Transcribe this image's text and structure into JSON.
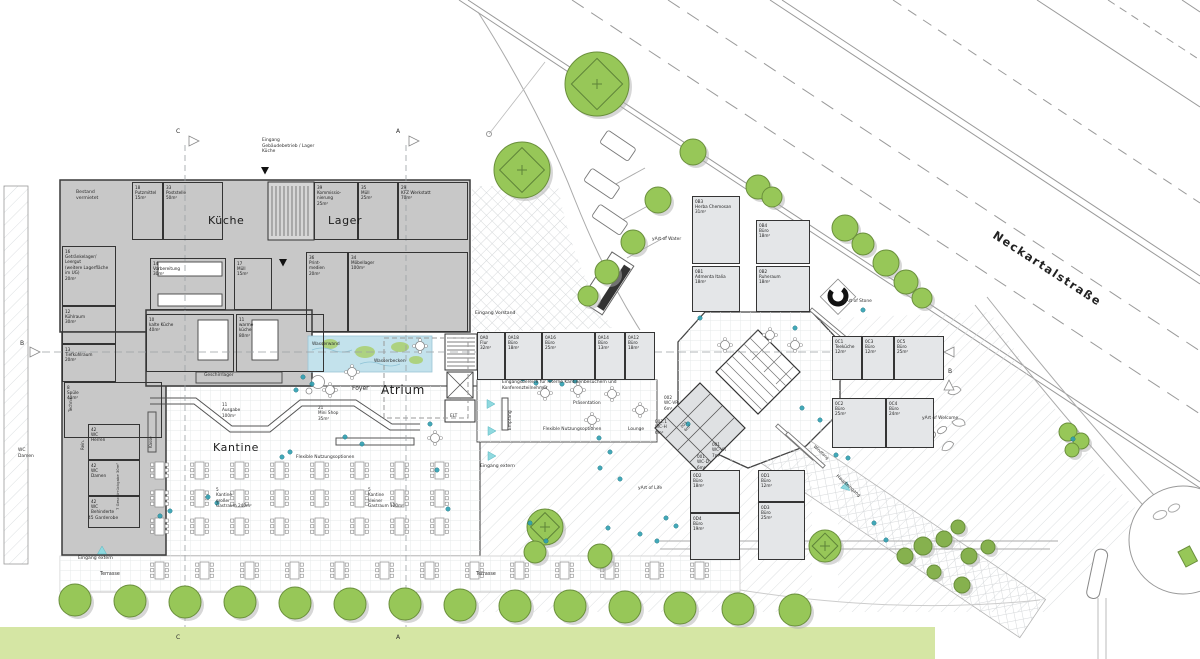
{
  "areas": {
    "kueche": "Küche",
    "lager": "Lager",
    "kantine": "Kantine",
    "atrium": "Atrium",
    "street_name": "Neckartalstraße"
  },
  "colors": {
    "accent_teal": "#2fa0b2",
    "entry_cyan": "#8fd9df",
    "tree_green": "#97c758",
    "tree_stroke": "#6a8f3c",
    "bush_green": "#86b14e",
    "green_band": "#d5e6a4",
    "building_gray": "#c8c8c8",
    "office_fill": "#e4e6e8",
    "wall": "#3a3a3a",
    "water": "#c3e2ec"
  },
  "rooms": [
    {
      "id": "18",
      "name": "Putzmittel",
      "area": "15m²",
      "x": 132,
      "y": 182,
      "w": 31,
      "h": 58,
      "cls": "g"
    },
    {
      "id": "33",
      "name": "Poststelle",
      "area": "50m²",
      "x": 163,
      "y": 182,
      "w": 60,
      "h": 58,
      "cls": "g"
    },
    {
      "id": "39",
      "name": "Kommissio-\nnierung",
      "area": "25m²",
      "x": 314,
      "y": 182,
      "w": 44,
      "h": 58,
      "cls": "g"
    },
    {
      "id": "35",
      "name": "Müll",
      "area": "25m²",
      "x": 358,
      "y": 182,
      "w": 40,
      "h": 58,
      "cls": "g"
    },
    {
      "id": "29",
      "name": "KFZ Werkstatt",
      "area": "70m²",
      "x": 398,
      "y": 182,
      "w": 70,
      "h": 58,
      "cls": "g"
    },
    {
      "id": "16",
      "name": "Getränkelager/\nLeergut\n(weitere Lagerfläche\nim UG)",
      "area": "20m²",
      "x": 62,
      "y": 246,
      "w": 54,
      "h": 60,
      "cls": "g"
    },
    {
      "id": "12",
      "name": "Kühlraum",
      "area": "30m²",
      "x": 62,
      "y": 306,
      "w": 54,
      "h": 38,
      "cls": "g"
    },
    {
      "id": "13",
      "name": "Tiefkühlraum",
      "area": "20m²",
      "x": 62,
      "y": 344,
      "w": 54,
      "h": 38,
      "cls": "g"
    },
    {
      "id": "8",
      "name": "Spüle",
      "area": "40m²",
      "x": 64,
      "y": 382,
      "w": 98,
      "h": 56,
      "cls": "g"
    },
    {
      "id": "14",
      "name": "Vorbereitung",
      "area": "30m²",
      "x": 150,
      "y": 258,
      "w": 76,
      "h": 52,
      "cls": "g"
    },
    {
      "id": "17",
      "name": "Müll",
      "area": "15m²",
      "x": 234,
      "y": 258,
      "w": 38,
      "h": 52,
      "cls": "g"
    },
    {
      "id": "36",
      "name": "Print-\nmedien",
      "area": "20m²",
      "x": 306,
      "y": 252,
      "w": 42,
      "h": 80,
      "cls": "g"
    },
    {
      "id": "34",
      "name": "Möbellager",
      "area": "100m²",
      "x": 348,
      "y": 252,
      "w": 120,
      "h": 80,
      "cls": "g"
    },
    {
      "id": "10",
      "name": "kalte Küche",
      "area": "40m²",
      "x": 146,
      "y": 314,
      "w": 88,
      "h": 58,
      "cls": "g"
    },
    {
      "id": "11",
      "name": "warme\nküche",
      "area": "80m²",
      "x": 236,
      "y": 314,
      "w": 88,
      "h": 58,
      "cls": "g"
    },
    {
      "id": "42",
      "name": "WC\nHerren",
      "area": "",
      "x": 88,
      "y": 424,
      "w": 52,
      "h": 36,
      "cls": "g"
    },
    {
      "id": "42",
      "name": "WC\nDamen",
      "area": "",
      "x": 88,
      "y": 460,
      "w": 52,
      "h": 36,
      "cls": "g"
    },
    {
      "id": "42",
      "name": "WC\nBehinderte",
      "area": "",
      "x": 88,
      "y": 496,
      "w": 52,
      "h": 32,
      "cls": "g"
    },
    {
      "id": "0A0",
      "name": "Flur",
      "area": "32m²",
      "x": 477,
      "y": 332,
      "w": 28,
      "h": 48,
      "cls": "o"
    },
    {
      "id": "0A18",
      "name": "Büro",
      "area": "18m²",
      "x": 505,
      "y": 332,
      "w": 37,
      "h": 48,
      "cls": "o"
    },
    {
      "id": "0A16",
      "name": "Büro",
      "area": "25m²",
      "x": 542,
      "y": 332,
      "w": 53,
      "h": 48,
      "cls": "o"
    },
    {
      "id": "0A14",
      "name": "Büro",
      "area": "13m²",
      "x": 595,
      "y": 332,
      "w": 30,
      "h": 48,
      "cls": "o"
    },
    {
      "id": "0A12",
      "name": "Büro",
      "area": "18m²",
      "x": 625,
      "y": 332,
      "w": 30,
      "h": 48,
      "cls": "o"
    },
    {
      "id": "0B3",
      "name": "Herba Chemosan",
      "area": "31m²",
      "x": 692,
      "y": 196,
      "w": 48,
      "h": 68,
      "cls": "o"
    },
    {
      "id": "0B4",
      "name": "Büro",
      "area": "18m²",
      "x": 756,
      "y": 220,
      "w": 54,
      "h": 44,
      "cls": "o"
    },
    {
      "id": "0B1",
      "name": "Admenta Italia",
      "area": "18m²",
      "x": 692,
      "y": 266,
      "w": 48,
      "h": 46,
      "cls": "o"
    },
    {
      "id": "0B2",
      "name": "Ruheraum",
      "area": "18m²",
      "x": 756,
      "y": 266,
      "w": 54,
      "h": 46,
      "cls": "o"
    },
    {
      "id": "0C1",
      "name": "Teeküche",
      "area": "12m²",
      "x": 832,
      "y": 336,
      "w": 30,
      "h": 44,
      "cls": "o"
    },
    {
      "id": "0C3",
      "name": "Büro",
      "area": "12m²",
      "x": 862,
      "y": 336,
      "w": 32,
      "h": 44,
      "cls": "o"
    },
    {
      "id": "0C5",
      "name": "Büro",
      "area": "25m²",
      "x": 894,
      "y": 336,
      "w": 50,
      "h": 44,
      "cls": "o"
    },
    {
      "id": "0C2",
      "name": "Büro",
      "area": "25m²",
      "x": 832,
      "y": 398,
      "w": 54,
      "h": 50,
      "cls": "o"
    },
    {
      "id": "0C4",
      "name": "Büro",
      "area": "24m²",
      "x": 886,
      "y": 398,
      "w": 48,
      "h": 50,
      "cls": "o"
    },
    {
      "id": "0D2",
      "name": "Büro",
      "area": "18m²",
      "x": 690,
      "y": 470,
      "w": 50,
      "h": 43,
      "cls": "o"
    },
    {
      "id": "0D1",
      "name": "Büro",
      "area": "12m²",
      "x": 758,
      "y": 470,
      "w": 47,
      "h": 32,
      "cls": "o"
    },
    {
      "id": "0D4",
      "name": "Büro",
      "area": "19m²",
      "x": 690,
      "y": 513,
      "w": 50,
      "h": 47,
      "cls": "o"
    },
    {
      "id": "0D3",
      "name": "Büro",
      "area": "25m²",
      "x": 758,
      "y": 502,
      "w": 47,
      "h": 58,
      "cls": "o"
    },
    {
      "id": "5",
      "name": "Kantine\ngroßer\nGastraum 240m²",
      "area": "",
      "x": 216,
      "y": 487,
      "w": 0,
      "h": 0
    },
    {
      "id": "5",
      "name": "Kantine\nkleiner\nGastraum 120m²",
      "area": "",
      "x": 368,
      "y": 487,
      "w": 0,
      "h": 0
    },
    {
      "id": "11",
      "name": "Ausgabe",
      "area": "100m²",
      "x": 222,
      "y": 402,
      "w": 0,
      "h": 0
    },
    {
      "id": "21",
      "name": "Mini Shop",
      "area": "35m²",
      "x": 318,
      "y": 405,
      "w": 0,
      "h": 0
    },
    {
      "id": "002",
      "name": "WC-VR",
      "area": "6m²",
      "x": 664,
      "y": 395,
      "w": 0,
      "h": 0
    },
    {
      "id": "002.1",
      "name": "WC-H",
      "area": "6m²",
      "x": 655,
      "y": 419,
      "w": 0,
      "h": 0
    },
    {
      "id": "001",
      "name": "WC-VR",
      "area": "7m²",
      "x": 712,
      "y": 442,
      "w": 0,
      "h": 0
    },
    {
      "id": "001",
      "name": "WC-D",
      "area": "6m²",
      "x": 697,
      "y": 454,
      "w": 0,
      "h": 0
    }
  ],
  "labels": [
    {
      "t": "Foyer",
      "x": 352,
      "y": 385,
      "s": 6,
      "n": "area-foyer"
    },
    {
      "t": "Bestand\nvermietet",
      "x": 76,
      "y": 190,
      "s": 4.6,
      "n": "bestand-label"
    },
    {
      "t": "Wasserwand",
      "x": 312,
      "y": 342,
      "s": 4.4,
      "n": "wasserwand-label"
    },
    {
      "t": "Wasserbecken",
      "x": 374,
      "y": 359,
      "s": 4.4,
      "n": "wasserbecken-label"
    },
    {
      "t": "Geschirrlager",
      "x": 204,
      "y": 373,
      "s": 4.4,
      "n": "geschirrlager-label"
    },
    {
      "t": "Terrasse",
      "x": 100,
      "y": 572,
      "s": 4.8,
      "n": "terrasse-label"
    },
    {
      "t": "Terrasse",
      "x": 476,
      "y": 572,
      "s": 4.8,
      "n": "terrasse-label"
    },
    {
      "t": "Eingang extern",
      "x": 78,
      "y": 556,
      "s": 4.6,
      "n": "entrance-label"
    },
    {
      "t": "Eingang extern",
      "x": 480,
      "y": 464,
      "s": 4.6,
      "n": "entrance-label"
    },
    {
      "t": "Eingang Vorstand",
      "x": 475,
      "y": 311,
      "s": 4.6,
      "n": "entrance-label"
    },
    {
      "t": "Eingang\nGebäudebetrieb / Lager\nKüche",
      "x": 262,
      "y": 138,
      "s": 4.4,
      "n": "entrance-label"
    },
    {
      "t": "Eingangsbereich für interne Kantinenbesuchern und\nKonferenzteilnehmer",
      "x": 502,
      "y": 380,
      "s": 4.4,
      "n": "annotation"
    },
    {
      "t": "Präsentation",
      "x": 573,
      "y": 401,
      "s": 4.4,
      "n": "area-praesentation"
    },
    {
      "t": "Flexible Nutzungsoptionen",
      "x": 543,
      "y": 427,
      "s": 4.4,
      "n": "area-flexible"
    },
    {
      "t": "Flexible Nutzungsoptionen",
      "x": 296,
      "y": 455,
      "s": 4.4,
      "n": "area-flexible"
    },
    {
      "t": "Lounge",
      "x": 628,
      "y": 427,
      "s": 4.4,
      "n": "area-lounge"
    },
    {
      "t": "Empfang",
      "x": 508,
      "y": 430,
      "s": 4.4,
      "rot": -90,
      "n": "area-empfang"
    },
    {
      "t": "Kasse",
      "x": 148,
      "y": 448,
      "s": 4,
      "rot": -90,
      "n": "area-kasse"
    },
    {
      "t": "Technik",
      "x": 68,
      "y": 412,
      "s": 4,
      "rot": -90,
      "n": "area-technik"
    },
    {
      "t": "Rein.",
      "x": 80,
      "y": 450,
      "s": 4,
      "rot": -90,
      "n": "area-rein"
    },
    {
      "t": "7 Geschirrückgabe 30m²",
      "x": 116,
      "y": 510,
      "s": 3.8,
      "rot": -90,
      "n": "area-geschirrrueckgabe"
    },
    {
      "t": "45 Garderobe",
      "x": 88,
      "y": 516,
      "s": 4.4,
      "n": "area-garderobe"
    },
    {
      "t": "WC\nDamen",
      "x": 18,
      "y": 448,
      "s": 4.4,
      "n": "wc-damen-sign"
    },
    {
      "t": "yArt of Water",
      "x": 652,
      "y": 237,
      "s": 4.4,
      "n": "art-label"
    },
    {
      "t": "yArt of Stone",
      "x": 843,
      "y": 299,
      "s": 4.4,
      "n": "art-label"
    },
    {
      "t": "yArt of Welcome",
      "x": 922,
      "y": 416,
      "s": 4.4,
      "n": "art-label"
    },
    {
      "t": "yArt of Life",
      "x": 638,
      "y": 486,
      "s": 4.4,
      "n": "art-label"
    },
    {
      "t": "Haupteingang",
      "x": 838,
      "y": 474,
      "s": 4.4,
      "rot": 42,
      "n": "entrance-label"
    },
    {
      "t": "Windfang",
      "x": 816,
      "y": 444,
      "s": 4,
      "rot": 42,
      "n": "area-windfang"
    },
    {
      "t": "ELT",
      "x": 450,
      "y": 414,
      "s": 4.4,
      "n": "area-elt"
    },
    {
      "t": "003\n6m²",
      "x": 680,
      "y": 426,
      "s": 3.8,
      "rot": -45,
      "n": "room-003-label"
    },
    {
      "t": "A",
      "x": 396,
      "y": 128,
      "s": 6,
      "n": "section-letter"
    },
    {
      "t": "C",
      "x": 176,
      "y": 128,
      "s": 6,
      "n": "section-letter"
    },
    {
      "t": "B",
      "x": 20,
      "y": 340,
      "s": 6,
      "n": "section-letter"
    },
    {
      "t": "B",
      "x": 948,
      "y": 368,
      "s": 6,
      "n": "section-letter"
    },
    {
      "t": "C",
      "x": 176,
      "y": 634,
      "s": 6,
      "n": "section-letter"
    },
    {
      "t": "A",
      "x": 396,
      "y": 634,
      "s": 6,
      "n": "section-letter"
    }
  ],
  "trees": [
    [
      75,
      600,
      16,
      0
    ],
    [
      130,
      601,
      16,
      0
    ],
    [
      185,
      602,
      16,
      0
    ],
    [
      240,
      602,
      16,
      0
    ],
    [
      295,
      603,
      16,
      0
    ],
    [
      350,
      604,
      16,
      0
    ],
    [
      405,
      604,
      16,
      0
    ],
    [
      460,
      605,
      16,
      0
    ],
    [
      515,
      606,
      16,
      0
    ],
    [
      570,
      606,
      16,
      0
    ],
    [
      625,
      607,
      16,
      0
    ],
    [
      680,
      608,
      16,
      0
    ],
    [
      738,
      609,
      16,
      0
    ],
    [
      795,
      610,
      16,
      0
    ],
    [
      693,
      152,
      13,
      0
    ],
    [
      758,
      187,
      12,
      0
    ],
    [
      772,
      197,
      10,
      0
    ],
    [
      658,
      200,
      13,
      0
    ],
    [
      633,
      242,
      12,
      0
    ],
    [
      607,
      272,
      12,
      0
    ],
    [
      588,
      296,
      10,
      0
    ],
    [
      845,
      228,
      13,
      0
    ],
    [
      863,
      244,
      11,
      0
    ],
    [
      886,
      263,
      13,
      0
    ],
    [
      906,
      282,
      12,
      0
    ],
    [
      922,
      298,
      10,
      0
    ],
    [
      597,
      84,
      32,
      1
    ],
    [
      522,
      170,
      28,
      1
    ],
    [
      545,
      527,
      18,
      1
    ],
    [
      825,
      546,
      16,
      1
    ],
    [
      1068,
      432,
      9,
      0
    ],
    [
      1081,
      441,
      8,
      0
    ],
    [
      1072,
      450,
      7,
      0
    ],
    [
      535,
      552,
      11,
      0
    ],
    [
      600,
      556,
      12,
      0
    ],
    [
      905,
      556,
      8,
      2
    ],
    [
      923,
      546,
      9,
      2
    ],
    [
      944,
      539,
      8,
      2
    ],
    [
      958,
      527,
      7,
      2
    ],
    [
      969,
      556,
      8,
      2
    ],
    [
      988,
      547,
      7,
      2
    ],
    [
      934,
      572,
      7,
      2
    ],
    [
      962,
      585,
      8,
      2
    ]
  ],
  "tables": {
    "rows": [
      {
        "y": 462,
        "x0": 155,
        "step": 40,
        "count": 8
      },
      {
        "y": 490,
        "x0": 155,
        "step": 40,
        "count": 8
      },
      {
        "y": 518,
        "x0": 155,
        "step": 40,
        "count": 8
      },
      {
        "y": 562,
        "x0": 155,
        "step": 45,
        "count": 13
      }
    ],
    "round": [
      [
        545,
        393
      ],
      [
        578,
        390
      ],
      [
        612,
        394
      ],
      [
        592,
        420
      ],
      [
        352,
        372
      ],
      [
        420,
        346
      ],
      [
        330,
        390
      ],
      [
        435,
        438
      ],
      [
        640,
        410
      ],
      [
        795,
        345
      ],
      [
        725,
        345
      ],
      [
        770,
        335
      ]
    ]
  },
  "people_dots": [
    [
      303,
      377
    ],
    [
      312,
      384
    ],
    [
      296,
      390
    ],
    [
      290,
      452
    ],
    [
      282,
      457
    ],
    [
      208,
      497
    ],
    [
      217,
      503
    ],
    [
      345,
      437
    ],
    [
      362,
      444
    ],
    [
      430,
      424
    ],
    [
      437,
      470
    ],
    [
      448,
      509
    ],
    [
      523,
      379
    ],
    [
      536,
      383
    ],
    [
      550,
      380
    ],
    [
      562,
      384
    ],
    [
      575,
      381
    ],
    [
      599,
      438
    ],
    [
      610,
      452
    ],
    [
      600,
      468
    ],
    [
      620,
      479
    ],
    [
      530,
      523
    ],
    [
      546,
      541
    ],
    [
      608,
      528
    ],
    [
      640,
      534
    ],
    [
      657,
      541
    ],
    [
      700,
      318
    ],
    [
      795,
      328
    ],
    [
      802,
      408
    ],
    [
      820,
      420
    ],
    [
      848,
      458
    ],
    [
      863,
      310
    ],
    [
      1073,
      439
    ],
    [
      160,
      516
    ],
    [
      170,
      511
    ],
    [
      688,
      424
    ],
    [
      836,
      455
    ],
    [
      874,
      523
    ],
    [
      886,
      540
    ],
    [
      666,
      518
    ],
    [
      676,
      526
    ]
  ],
  "entry_triangles": [
    [
      102,
      551,
      0
    ],
    [
      490,
      347,
      90
    ],
    [
      490,
      404,
      90
    ],
    [
      491,
      431,
      90
    ],
    [
      491,
      456,
      90
    ],
    [
      846,
      487,
      135
    ]
  ],
  "door_triangles": [
    [
      265,
      170
    ],
    [
      283,
      262
    ]
  ]
}
